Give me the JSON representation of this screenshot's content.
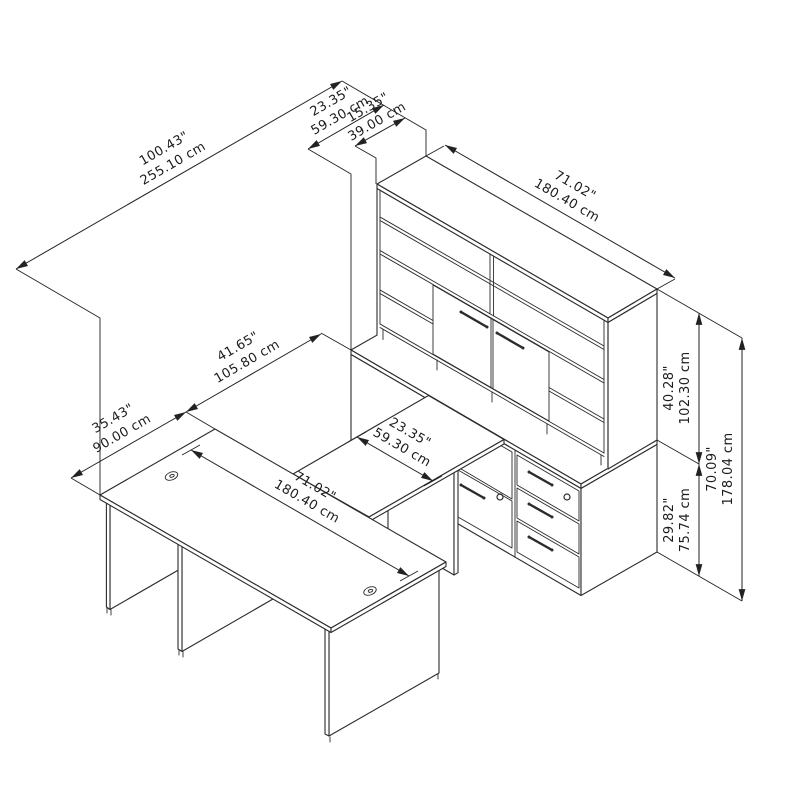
{
  "drawing": {
    "kind": "furniture-dimension-diagram",
    "subject": "U-shaped desk with bridge, credenza pedestals and hutch"
  },
  "colors": {
    "line": "#2b2b2b",
    "dim_line": "#222222",
    "background": "#ffffff"
  },
  "dims": {
    "overall_depth": {
      "in": "100.43\"",
      "cm": "255.10 cm"
    },
    "credenza_depth": {
      "in": "23.35\"",
      "cm": "59.30 cm"
    },
    "hutch_depth": {
      "in": "15.35\"",
      "cm": "39.00 cm"
    },
    "hutch_width": {
      "in": "71.02\"",
      "cm": "180.40 cm"
    },
    "bridge_length": {
      "in": "41.65\"",
      "cm": "105.80 cm"
    },
    "bridge_width": {
      "in": "23.35\"",
      "cm": "59.30 cm"
    },
    "desk_depth": {
      "in": "35.43\"",
      "cm": "90.00 cm"
    },
    "desk_width": {
      "in": "71.02\"",
      "cm": "180.40 cm"
    },
    "hutch_height": {
      "in": "40.28\"",
      "cm": "102.30 cm"
    },
    "desk_height": {
      "in": "29.82\"",
      "cm": "75.74 cm"
    },
    "total_height": {
      "in": "70.09\"",
      "cm": "178.04 cm"
    }
  }
}
